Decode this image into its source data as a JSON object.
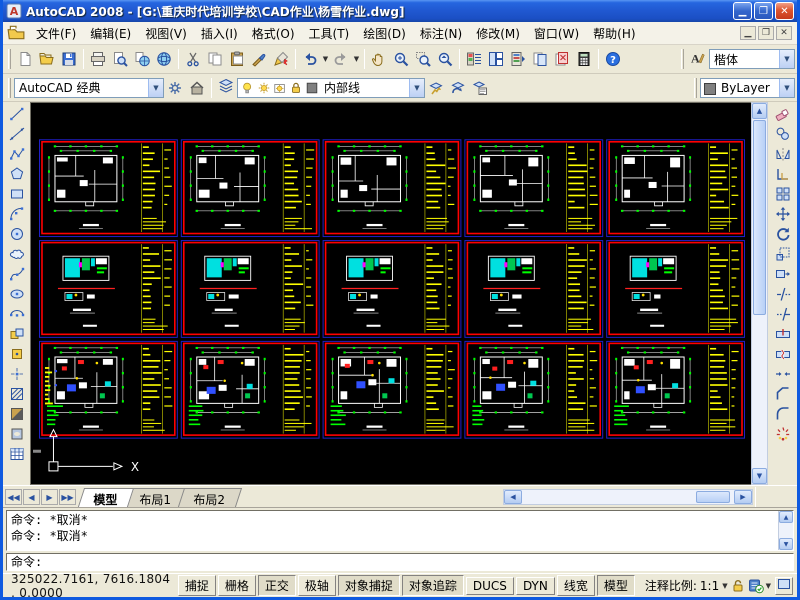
{
  "titlebar": {
    "title": "AutoCAD 2008 - [G:\\重庆时代培训学校\\CAD作业\\杨雪作业.dwg]",
    "buttons": [
      "minimize",
      "restore",
      "close"
    ]
  },
  "menubar": {
    "items": [
      {
        "key": "file",
        "label": "文件(F)"
      },
      {
        "key": "edit",
        "label": "编辑(E)"
      },
      {
        "key": "view",
        "label": "视图(V)"
      },
      {
        "key": "insert",
        "label": "插入(I)"
      },
      {
        "key": "format",
        "label": "格式(O)"
      },
      {
        "key": "tools",
        "label": "工具(T)"
      },
      {
        "key": "draw",
        "label": "绘图(D)"
      },
      {
        "key": "dimension",
        "label": "标注(N)"
      },
      {
        "key": "modify",
        "label": "修改(M)"
      },
      {
        "key": "window",
        "label": "窗口(W)"
      },
      {
        "key": "help",
        "label": "帮助(H)"
      }
    ],
    "window_buttons": [
      "minimize",
      "restore",
      "close"
    ]
  },
  "toolbar_standard": {
    "groups": [
      [
        "new",
        "open",
        "save"
      ],
      [
        "plot",
        "plot-preview",
        "publish",
        "3d-dwf"
      ],
      [
        "cut",
        "copy",
        "paste",
        "match-properties",
        "block-editor"
      ],
      [
        "undo",
        "redo"
      ],
      [
        "pan",
        "zoom-realtime",
        "zoom-window",
        "zoom-previous"
      ],
      [
        "properties",
        "designcenter",
        "tool-palettes",
        "sheet-set-manager",
        "markup-set-manager",
        "quick-calc"
      ],
      [
        "help"
      ]
    ],
    "dropdown_after": [
      "undo",
      "redo"
    ]
  },
  "toolbar_styles": {
    "icon": "text-style",
    "value": "楷体"
  },
  "toolbar_workspaces": {
    "value": "AutoCAD 经典",
    "icons": [
      "gear",
      "my-workspace"
    ]
  },
  "toolbar_layers": {
    "palette_icon": "layers",
    "status_icons": [
      "bulb",
      "sun",
      "sun-vp",
      "lock",
      "swatch"
    ],
    "layer_name": "内部线",
    "tool_icons": [
      "layer-current",
      "layer-previous",
      "layer-states"
    ]
  },
  "toolbar_properties": {
    "color_value": "ByLayer"
  },
  "draw_toolbar": {
    "icons": [
      "line",
      "construction-line",
      "polyline",
      "polygon",
      "rectangle",
      "arc",
      "circle",
      "revision-cloud",
      "spline",
      "ellipse",
      "ellipse-arc",
      "insert-block",
      "make-block",
      "point",
      "hatch",
      "gradient",
      "region",
      "table"
    ]
  },
  "modify_toolbar": {
    "icons": [
      "erase",
      "copy-object",
      "mirror",
      "offset",
      "array",
      "move",
      "rotate",
      "scale",
      "stretch",
      "trim",
      "extend",
      "break-at-point",
      "break",
      "join",
      "chamfer",
      "fillet",
      "explode"
    ]
  },
  "canvas": {
    "background": "#000000",
    "grid": {
      "rows": 3,
      "cols": 5,
      "sheet_count": 15
    },
    "colors": {
      "sheet_frame": "#ff0000",
      "sheet_outer": "#2020c8",
      "plan": "#ffffff",
      "dimensions": "#00ff00",
      "notes": "#ffff00",
      "accent_cyan": "#00e0e0",
      "accent_green": "#00c850",
      "accent_magenta": "#ff00ff",
      "accent_blue": "#3050ff",
      "accent_red": "#ff2020",
      "accent_yellow": "#ffe000"
    },
    "ucs_label_x": "X"
  },
  "layout_tabs": {
    "nav": [
      "first",
      "previous",
      "next",
      "last"
    ],
    "tabs": [
      {
        "key": "model",
        "label": "模型",
        "active": true
      },
      {
        "key": "layout1",
        "label": "布局1",
        "active": false
      },
      {
        "key": "layout2",
        "label": "布局2",
        "active": false
      }
    ]
  },
  "command_window": {
    "history": [
      "命令: *取消*",
      "命令: *取消*"
    ],
    "prompt": "命令:"
  },
  "statusbar": {
    "coordinates": "325022.7161, 7616.1804 , 0.0000",
    "toggles": [
      {
        "key": "snap",
        "label": "捕捉",
        "pressed": false
      },
      {
        "key": "grid",
        "label": "栅格",
        "pressed": false
      },
      {
        "key": "ortho",
        "label": "正交",
        "pressed": true
      },
      {
        "key": "polar",
        "label": "极轴",
        "pressed": false
      },
      {
        "key": "osnap",
        "label": "对象捕捉",
        "pressed": true
      },
      {
        "key": "otrack",
        "label": "对象追踪",
        "pressed": true
      },
      {
        "key": "ducs",
        "label": "DUCS",
        "pressed": false
      },
      {
        "key": "dyn",
        "label": "DYN",
        "pressed": false
      },
      {
        "key": "lineweight",
        "label": "线宽",
        "pressed": false
      },
      {
        "key": "model",
        "label": "模型",
        "pressed": true
      }
    ],
    "annotation_scale_label": "注释比例:",
    "annotation_scale_value": "1:1",
    "right_icons": [
      "annotation-lock",
      "annotation-visibility",
      "menu-chevron",
      "clean-screen"
    ]
  }
}
